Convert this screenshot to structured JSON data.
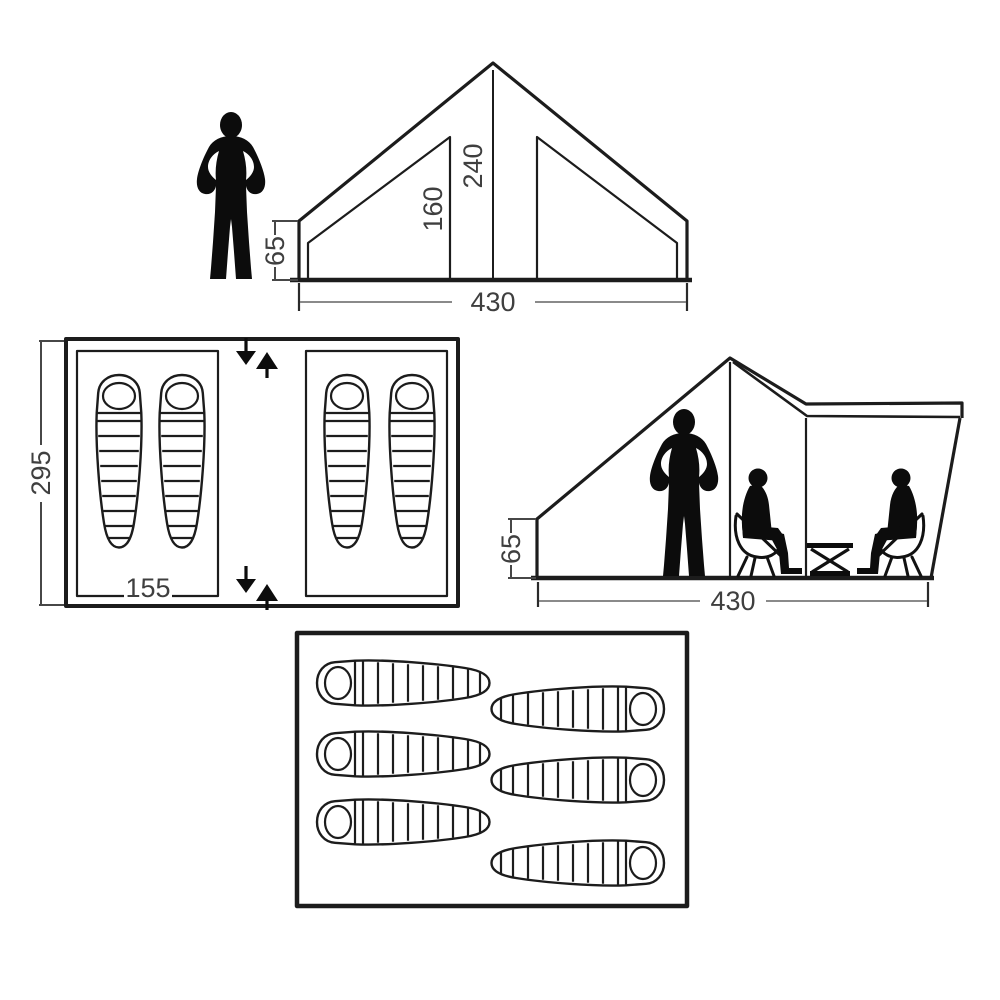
{
  "diagram_title": "",
  "colors": {
    "line": "#1c1c1c",
    "dimension_line": "#7a7a7a",
    "bracket": "#474747",
    "label_text": "#3f3f3f",
    "silhouette": "#0c0c0c",
    "background": "#ffffff"
  },
  "front_view": {
    "ridge_height": "240",
    "inner_cabin_height": "160",
    "wall_height": "65",
    "width": "430"
  },
  "floor_plan": {
    "depth": "295",
    "cabin_width": "155"
  },
  "side_view": {
    "wall_height": "65",
    "length": "430"
  }
}
